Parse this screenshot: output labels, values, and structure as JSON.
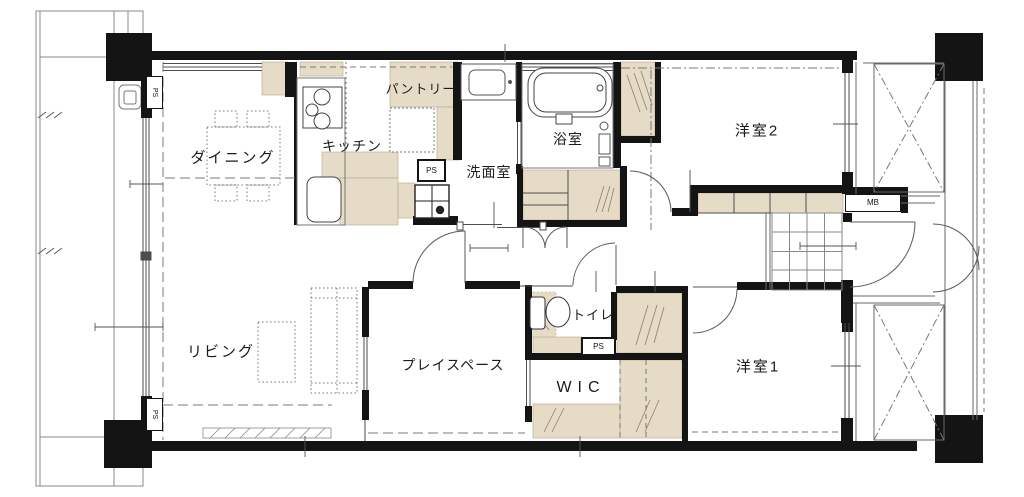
{
  "rooms": {
    "dining": {
      "label": "ダイニング"
    },
    "kitchen": {
      "label": "キッチン"
    },
    "pantry": {
      "label": "パントリー"
    },
    "washroom": {
      "label": "洗面室"
    },
    "bathroom": {
      "label": "浴室"
    },
    "bedroom2": {
      "label": "洋室2"
    },
    "living": {
      "label": "リビング"
    },
    "playspace": {
      "label": "プレイスペース"
    },
    "toilet": {
      "label": "トイレ"
    },
    "wic": {
      "label": "WIC"
    },
    "bedroom1": {
      "label": "洋室1"
    }
  },
  "markers": {
    "ps": "PS",
    "mb": "MB"
  },
  "colors": {
    "wall": "#141414",
    "storage_fill": "#e6dbc6",
    "line": "#4d4d4d",
    "background": "#ffffff"
  }
}
